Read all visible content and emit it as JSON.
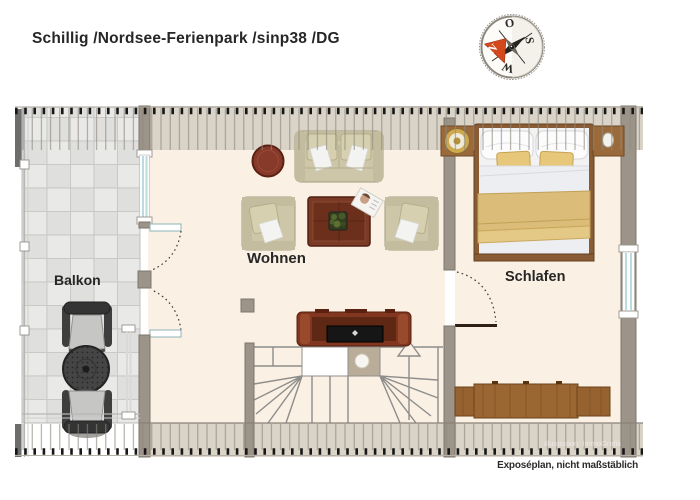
{
  "header": {
    "title": "Schillig /Nordsee-Ferienpark /sinp38 /DG"
  },
  "compass": {
    "top": "O",
    "right": "S",
    "bottom": "W",
    "needle": "N"
  },
  "rooms": {
    "balcony": "Balkon",
    "living": "Wohnen",
    "bedroom": "Schlafen"
  },
  "footer": {
    "caption": "Exposéplan, nicht maßstäblich",
    "watermark": "Illustration: ImmoGrafik"
  },
  "colors": {
    "floor": "#faf0e3",
    "wall": "#9c9389",
    "band": "#d9d3c8",
    "tile": "#e9e9e7",
    "window": "#bcdbe0",
    "wood": "#96622f",
    "redwood": "#7c3722",
    "sofa": "#cec7ab",
    "tan": "#e4c67c",
    "compass_red": "#d4481e",
    "ink": "#262626"
  }
}
